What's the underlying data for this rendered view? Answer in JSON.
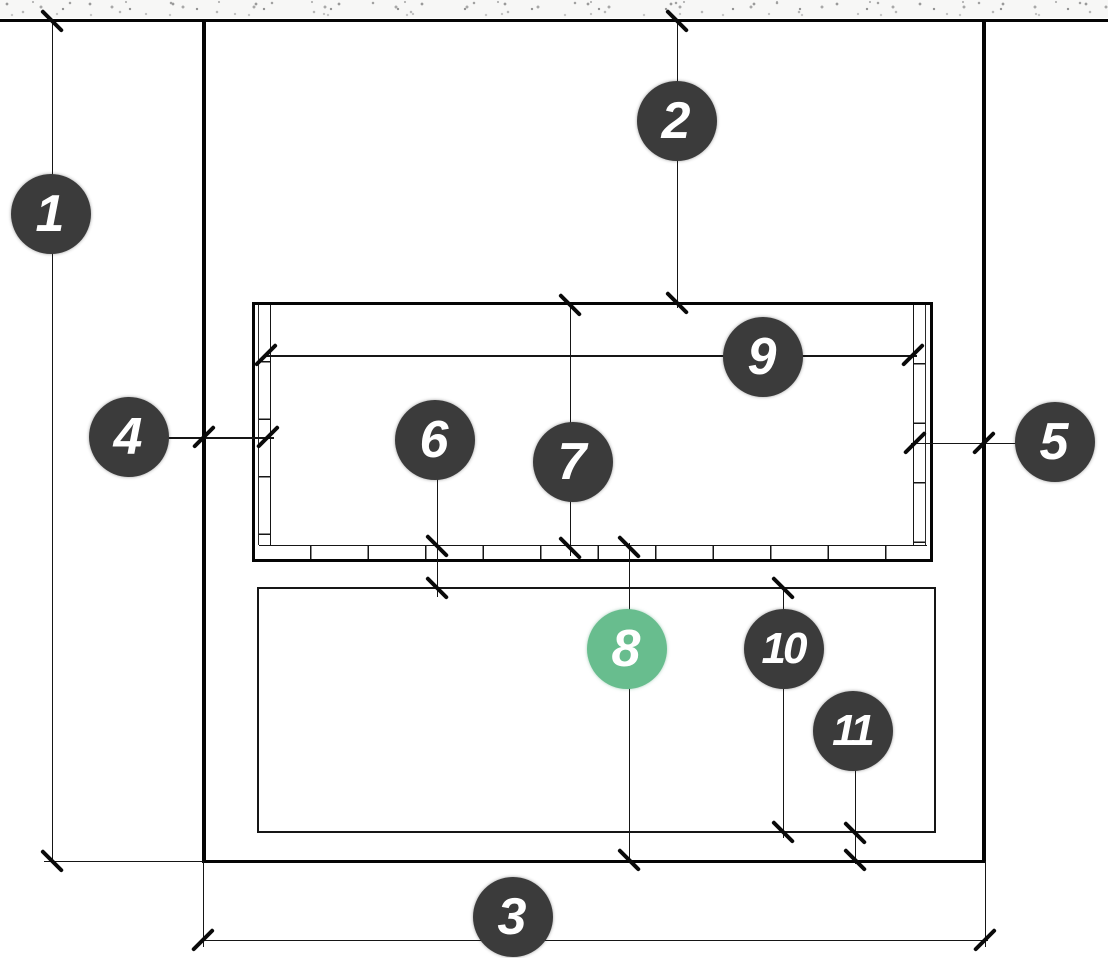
{
  "diagram": {
    "type": "architectural-elevation-with-numbered-callouts",
    "callouts": [
      {
        "id": 1,
        "label": "1",
        "style": "dark"
      },
      {
        "id": 2,
        "label": "2",
        "style": "dark"
      },
      {
        "id": 3,
        "label": "3",
        "style": "dark"
      },
      {
        "id": 4,
        "label": "4",
        "style": "dark"
      },
      {
        "id": 5,
        "label": "5",
        "style": "dark"
      },
      {
        "id": 6,
        "label": "6",
        "style": "dark"
      },
      {
        "id": 7,
        "label": "7",
        "style": "dark"
      },
      {
        "id": 8,
        "label": "8",
        "style": "green"
      },
      {
        "id": 9,
        "label": "9",
        "style": "dark"
      },
      {
        "id": 10,
        "label": "10",
        "style": "dark"
      },
      {
        "id": 11,
        "label": "11",
        "style": "dark"
      }
    ],
    "colors": {
      "badge_dark": "#3b3b3b",
      "badge_green": "#68bd8e",
      "badge_text": "#ffffff",
      "line": "#111111",
      "texture_speck": "#a5a5a5",
      "background": "#ffffff"
    }
  }
}
